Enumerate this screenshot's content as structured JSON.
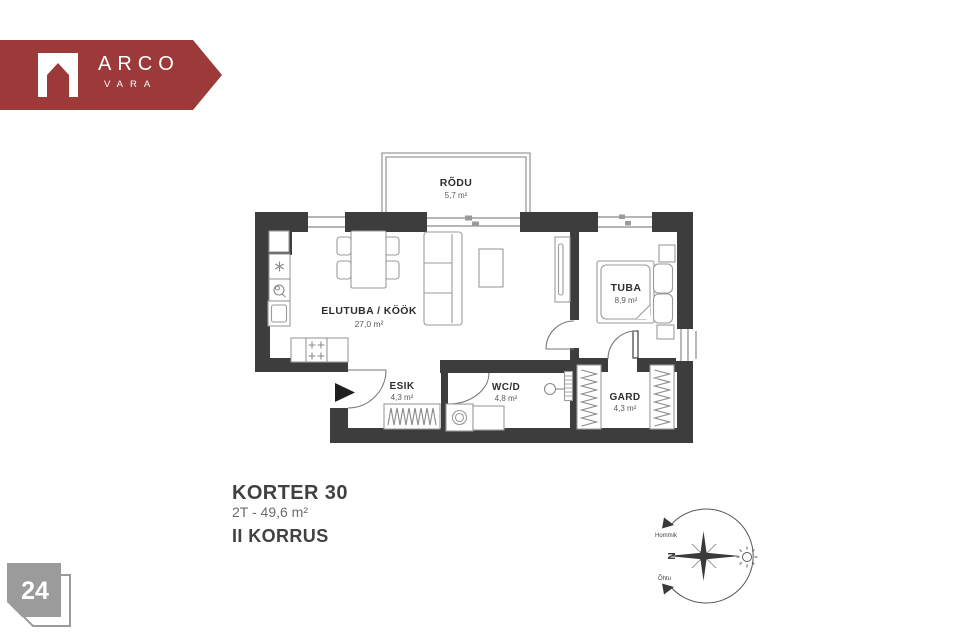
{
  "brand": {
    "name": "ARCO",
    "sub": "VARA",
    "banner_color": "#9c3a3a"
  },
  "floorplan": {
    "wall_color": "#3d3d3d",
    "rooms": [
      {
        "name": "RÕDU",
        "area": "5,7 m²"
      },
      {
        "name": "ELUTUBA / KÖÖK",
        "area": "27,0 m²"
      },
      {
        "name": "TUBA",
        "area": "8,9 m²"
      },
      {
        "name": "ESIK",
        "area": "4,3 m²"
      },
      {
        "name": "WC/D",
        "area": "4,8 m²"
      },
      {
        "name": "GARD",
        "area": "4,3 m²"
      }
    ]
  },
  "caption": {
    "title": "KORTER 30",
    "subtitle": "2T - 49,6 m²",
    "floor": "II KORRUS"
  },
  "compass": {
    "north": "N",
    "morning": "Hommik",
    "evening": "Õhtu"
  },
  "page": {
    "number": "24"
  }
}
